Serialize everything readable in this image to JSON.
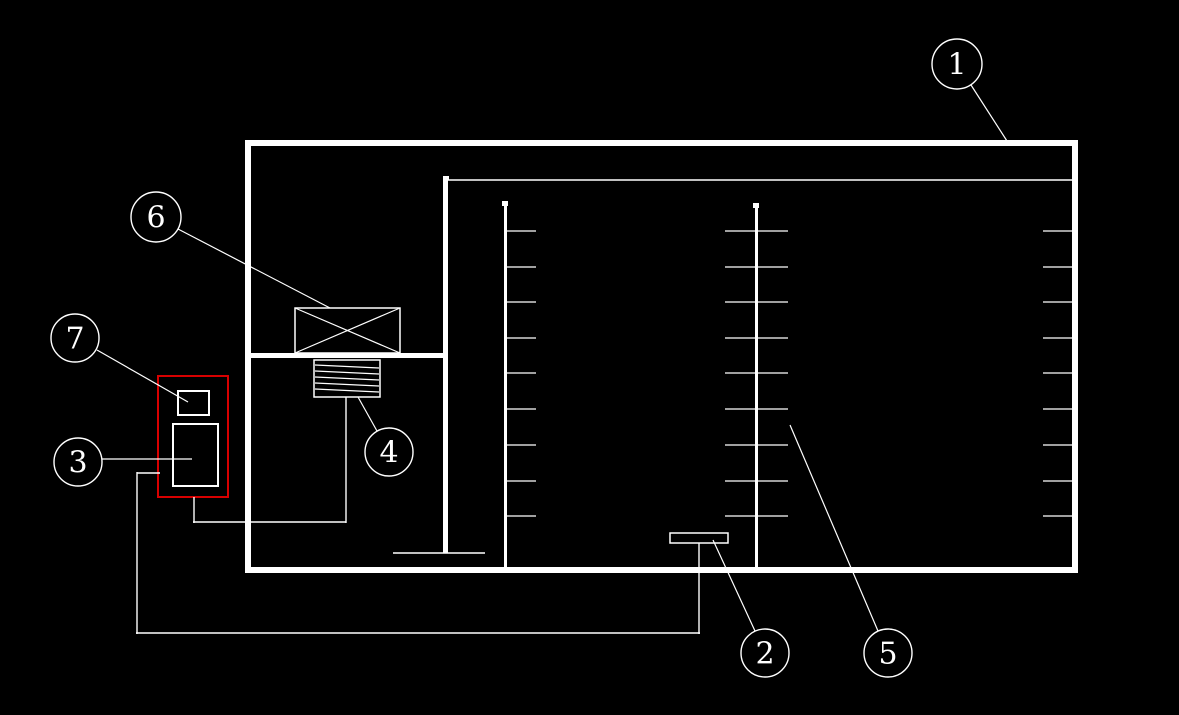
{
  "app": {
    "kind": "cad-plan-view",
    "visible_text": [
      "1",
      "2",
      "3",
      "4",
      "5",
      "6",
      "7"
    ]
  },
  "colors": {
    "background": "#000000",
    "line": "#ffffff",
    "highlight": "#d80000",
    "label_text": "#ffffff"
  },
  "drawing": {
    "width": 1179,
    "height": 715,
    "label_font_size": 30,
    "walls": [
      {
        "name": "outer-wall-top",
        "x": 245,
        "y": 140,
        "w": 833,
        "h": 6
      },
      {
        "name": "outer-wall-bottom",
        "x": 245,
        "y": 567,
        "w": 833,
        "h": 6
      },
      {
        "name": "outer-wall-left",
        "x": 245,
        "y": 140,
        "w": 6,
        "h": 433
      },
      {
        "name": "outer-wall-right",
        "x": 1072,
        "y": 140,
        "w": 6,
        "h": 433
      },
      {
        "name": "inner-wall-vertical",
        "x": 443,
        "y": 178,
        "w": 5,
        "h": 375
      },
      {
        "name": "inner-wall-horizontal",
        "x": 251,
        "y": 353,
        "w": 192,
        "h": 5
      },
      {
        "name": "grille-stem-left",
        "x": 504,
        "y": 203,
        "w": 3,
        "h": 364
      },
      {
        "name": "grille-stem-middle",
        "x": 755,
        "y": 205,
        "w": 3,
        "h": 362
      },
      {
        "name": "node-marker-left-stem",
        "x": 502,
        "y": 201,
        "w": 6,
        "h": 5
      },
      {
        "name": "node-marker-middle-stem",
        "x": 753,
        "y": 203,
        "w": 6,
        "h": 5
      },
      {
        "name": "node-marker-inner-wall",
        "x": 443,
        "y": 176,
        "w": 6,
        "h": 4
      }
    ],
    "boxes": [
      {
        "name": "fan-unit-box",
        "x": 295,
        "y": 308,
        "w": 105,
        "h": 45,
        "stroke": 1.5
      },
      {
        "name": "coil-box",
        "x": 314,
        "y": 360,
        "w": 66,
        "h": 37,
        "stroke": 1.5
      },
      {
        "name": "floor-outlet-box",
        "x": 670,
        "y": 533,
        "w": 58,
        "h": 10,
        "stroke": 1.5
      },
      {
        "name": "highlight-zone-box",
        "x": 158,
        "y": 376,
        "w": 70,
        "h": 121,
        "stroke": 2,
        "color": "#d80000"
      },
      {
        "name": "small-device-box",
        "x": 178,
        "y": 391,
        "w": 31,
        "h": 24,
        "stroke": 2
      },
      {
        "name": "control-device-box",
        "x": 173,
        "y": 424,
        "w": 45,
        "h": 62,
        "stroke": 2
      }
    ],
    "lines": [
      {
        "name": "inner-ceiling-line",
        "pts": [
          448,
          180,
          1072,
          180
        ],
        "w": 1.5
      },
      {
        "name": "fan-box-diagonal-1",
        "pts": [
          295,
          308,
          400,
          353
        ],
        "w": 1.2
      },
      {
        "name": "fan-box-diagonal-2",
        "pts": [
          400,
          308,
          295,
          353
        ],
        "w": 1.2
      },
      {
        "name": "coil-fin-line-1",
        "pts": [
          315,
          365,
          379,
          368
        ],
        "w": 1.2
      },
      {
        "name": "coil-fin-line-2",
        "pts": [
          315,
          371,
          379,
          374
        ],
        "w": 1.2
      },
      {
        "name": "coil-fin-line-3",
        "pts": [
          315,
          377,
          379,
          380
        ],
        "w": 1.2
      },
      {
        "name": "coil-fin-line-4",
        "pts": [
          315,
          383,
          379,
          386
        ],
        "w": 1.2
      },
      {
        "name": "coil-fin-line-5",
        "pts": [
          315,
          389,
          379,
          392
        ],
        "w": 1.2
      },
      {
        "name": "inner-wall-end-cap",
        "pts": [
          393,
          553,
          485,
          553
        ],
        "w": 1.5
      },
      {
        "name": "pipe-device-drop",
        "pts": [
          194,
          497,
          194,
          523
        ],
        "w": 1.4
      },
      {
        "name": "pipe-device-run",
        "pts": [
          193,
          522,
          346,
          522
        ],
        "w": 1.4
      },
      {
        "name": "pipe-coil-riser",
        "pts": [
          346,
          523,
          346,
          397
        ],
        "w": 1.4
      },
      {
        "name": "pipe-zone-stub",
        "pts": [
          137,
          473,
          160,
          473
        ],
        "w": 1.4
      },
      {
        "name": "pipe-left-drop",
        "pts": [
          137,
          472,
          137,
          634
        ],
        "w": 1.4
      },
      {
        "name": "pipe-bottom-run",
        "pts": [
          136,
          633,
          700,
          633
        ],
        "w": 1.4
      },
      {
        "name": "pipe-outlet-riser",
        "pts": [
          699,
          634,
          699,
          543
        ],
        "w": 1.4
      }
    ],
    "tick_groups": [
      {
        "name": "grille-ticks-left",
        "x1": 507,
        "x2": 536,
        "ys": [
          231,
          267,
          302,
          338,
          373,
          409,
          445,
          481,
          516
        ]
      },
      {
        "name": "grille-ticks-middle-west",
        "x1": 725,
        "x2": 755,
        "ys": [
          231,
          267,
          302,
          338,
          373,
          409,
          445,
          481,
          516
        ]
      },
      {
        "name": "grille-ticks-middle-east",
        "x1": 758,
        "x2": 788,
        "ys": [
          231,
          267,
          302,
          338,
          373,
          409,
          445,
          481,
          516
        ]
      },
      {
        "name": "grille-ticks-right-wall",
        "x1": 1043,
        "x2": 1072,
        "ys": [
          231,
          267,
          302,
          338,
          373,
          409,
          445,
          481,
          516
        ]
      }
    ],
    "callouts": [
      {
        "label": "1",
        "cx": 957,
        "cy": 64,
        "r": 25,
        "leader": [
          971,
          85,
          1007,
          141
        ]
      },
      {
        "label": "2",
        "cx": 765,
        "cy": 653,
        "r": 24,
        "leader": [
          713,
          540,
          755,
          631
        ]
      },
      {
        "label": "3",
        "cx": 78,
        "cy": 462,
        "r": 24,
        "leader": [
          102,
          459,
          192,
          459
        ]
      },
      {
        "label": "4",
        "cx": 389,
        "cy": 452,
        "r": 24,
        "leader": [
          358,
          397,
          377,
          431
        ]
      },
      {
        "label": "5",
        "cx": 888,
        "cy": 653,
        "r": 24,
        "leader": [
          790,
          425,
          878,
          631
        ]
      },
      {
        "label": "6",
        "cx": 156,
        "cy": 217,
        "r": 25,
        "leader": [
          178,
          229,
          330,
          308
        ]
      },
      {
        "label": "7",
        "cx": 75,
        "cy": 338,
        "r": 24,
        "leader": [
          97,
          350,
          188,
          402
        ]
      }
    ]
  }
}
